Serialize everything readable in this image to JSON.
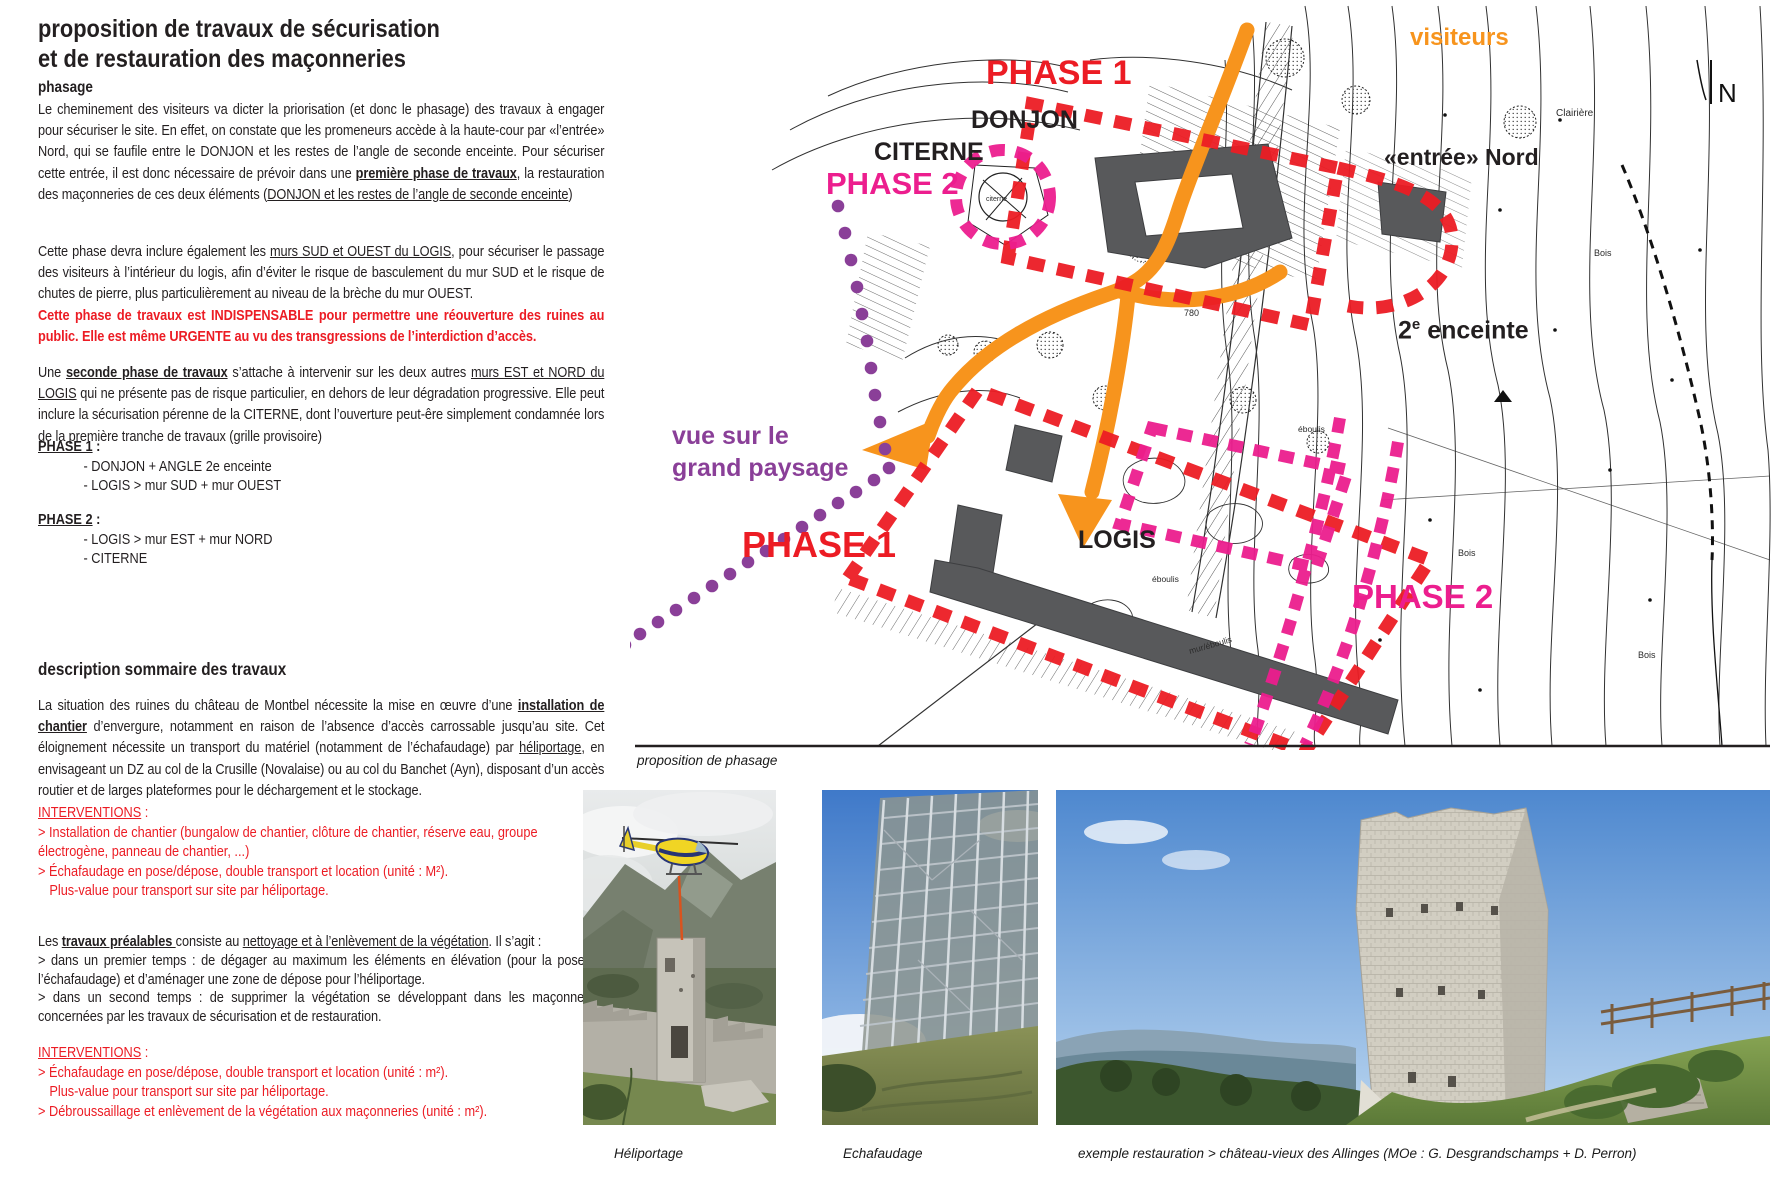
{
  "colors": {
    "red": "#ec1c24",
    "magenta": "#ec1e8e",
    "orange": "#f7941d",
    "purple": "#8a3f98",
    "ink": "#231f20",
    "building_grey": "#58595b"
  },
  "left": {
    "title_line1": "proposition de travaux de sécurisation",
    "title_line2": "et de restauration des maçonneries",
    "phasage": {
      "heading": "phasage",
      "p1": [
        {
          "t": "Le cheminement des visiteurs va dicter la priorisation (et donc le phasage) des travaux à engager pour sécuriser le site. En effet, on constate que les promeneurs accède à la haute-cour par «l’entrée» Nord, qui se faufile entre le DONJON et les restes de l’angle de seconde enceinte. Pour sécuriser cette entrée, il est donc nécessaire de prévoir dans une "
        },
        {
          "t": "première phase de travaux",
          "c": "b u"
        },
        {
          "t": ", la restauration des maçonneries de ces deux éléments ("
        },
        {
          "t": "DONJON et les restes de l’angle de seconde enceinte",
          "c": "u"
        },
        {
          "t": ")"
        }
      ],
      "p2": [
        {
          "t": "Cette phase devra inclure également les "
        },
        {
          "t": "murs SUD et OUEST du LOGIS",
          "c": "u"
        },
        {
          "t": ", pour sécuriser le passage des visiteurs à l’intérieur du logis, afin d’éviter le risque de basculement du mur SUD et le risque de chutes de pierre, plus particulièrement au niveau de la brèche du mur OUEST."
        }
      ],
      "p2red": [
        {
          "t": "Cette phase de travaux est INDISPENSABLE pour permettre une réouverture des ruines au public. Elle est même URGENTE au vu des transgressions de l’interdiction d’accès.",
          "c": "r b"
        }
      ],
      "p3": [
        {
          "t": "Une "
        },
        {
          "t": "seconde phase de travaux",
          "c": "b u"
        },
        {
          "t": " s’attache à intervenir sur les deux autres "
        },
        {
          "t": "murs EST et NORD du LOGIS",
          "c": "u"
        },
        {
          "t": " qui ne présente pas de risque particulier, en dehors de leur dégradation progressive. Elle peut inclure la sécurisation pérenne de la CITERNE, dont l’ouverture peut-êre simplement condamnée lors de la première tranche de travaux (grille provisoire)"
        }
      ],
      "phase1_heading": [
        {
          "t": "PHASE 1",
          "c": "b u"
        },
        {
          "t": " :",
          "c": "b"
        }
      ],
      "phase1_items": [
        "- DONJON + ANGLE 2e enceinte",
        "- LOGIS > mur SUD + mur OUEST"
      ],
      "phase2_heading": [
        {
          "t": "PHASE 2",
          "c": "b u"
        },
        {
          "t": " :",
          "c": "b"
        }
      ],
      "phase2_items": [
        "- LOGIS > mur EST + mur NORD",
        "- CITERNE"
      ]
    },
    "description": {
      "heading": "description sommaire des travaux",
      "p4": [
        {
          "t": "La situation des ruines du château de Montbel nécessite la mise en œuvre d’une "
        },
        {
          "t": "installation de chantier",
          "c": "b u"
        },
        {
          "t": " d’envergure, notamment en raison de l’absence d’accès carrossable jusqu’au site. Cet éloignement nécessite un transport du matériel (notamment de l’échafaudage) par "
        },
        {
          "t": "héliportage",
          "c": "u"
        },
        {
          "t": ", en envisageant un DZ au col de la Crusille (Novalaise) ou au col du Banchet (Ayn), disposant d’un accès routier et de larges plateformes pour le déchargement et le stockage."
        }
      ],
      "interventions1_heading": [
        {
          "t": "INTERVENTIONS",
          "c": "u"
        },
        {
          "t": " :"
        }
      ],
      "interventions1_item1": "> Installation de chantier (bungalow de chantier, clôture de chantier, réserve eau, groupe électrogène, panneau de chantier, ...)",
      "interventions1_item2": "> Échafaudage en pose/dépose, double transport et location (unité : M²).",
      "interventions1_item2b": "Plus-value pour transport sur site par héliportage.",
      "p5": [
        {
          "t": "Les "
        },
        {
          "t": "travaux préalables ",
          "c": "b u"
        },
        {
          "t": "consiste au "
        },
        {
          "t": "nettoyage et à l’enlèvement de la végétation",
          "c": "u"
        },
        {
          "t": ". Il s’agit :"
        }
      ],
      "p5a": "> dans un premier temps : de dégager au maximum les éléments en élévation (pour la pose de l’échafaudage) et d’aménager une zone de dépose pour l’héliportage.",
      "p5b": "> dans un second temps : de supprimer la végétation se développant dans les maçonneries concernées par les travaux de sécurisation et de restauration.",
      "interventions2_heading": [
        {
          "t": "INTERVENTIONS",
          "c": "u"
        },
        {
          "t": " :"
        }
      ],
      "interventions2_item1": "> Échafaudage en pose/dépose, double transport et location (unité : m²).",
      "interventions2_item1b": "Plus-value pour transport sur site par héliportage.",
      "interventions2_item2": "> Débroussaillage et enlèvement de la végétation aux maçonneries (unité : m²)."
    }
  },
  "map": {
    "caption": "proposition de phasage",
    "labels": {
      "visiteurs": "visiteurs",
      "phase1_top": "PHASE 1",
      "phase2_left": "PHASE 2",
      "donjon": "DONJON",
      "citerne": "CITERNE",
      "entree_nord": "«entrée» Nord",
      "enceinte2_base": "2",
      "enceinte2_sup": "e",
      "enceinte2_rest": " enceinte",
      "logis": "LOGIS",
      "phase1_bottom": "PHASE 1",
      "phase2_right": "PHASE 2",
      "vue_line1": "vue sur le",
      "vue_line2": "grand paysage",
      "north": "N"
    },
    "tiny": {
      "clairiere": "Clairière",
      "bois": "Bois",
      "alt780": "780",
      "eboulis": "éboulis",
      "mur_eboulis": "mur/éboulis",
      "citerne_small": "citerne"
    }
  },
  "photos": {
    "caption1": "Héliportage",
    "caption2": "Echafaudage",
    "caption3": "exemple restauration > château-vieux des Allinges (MOe : G. Desgrandschamps + D. Perron)"
  }
}
